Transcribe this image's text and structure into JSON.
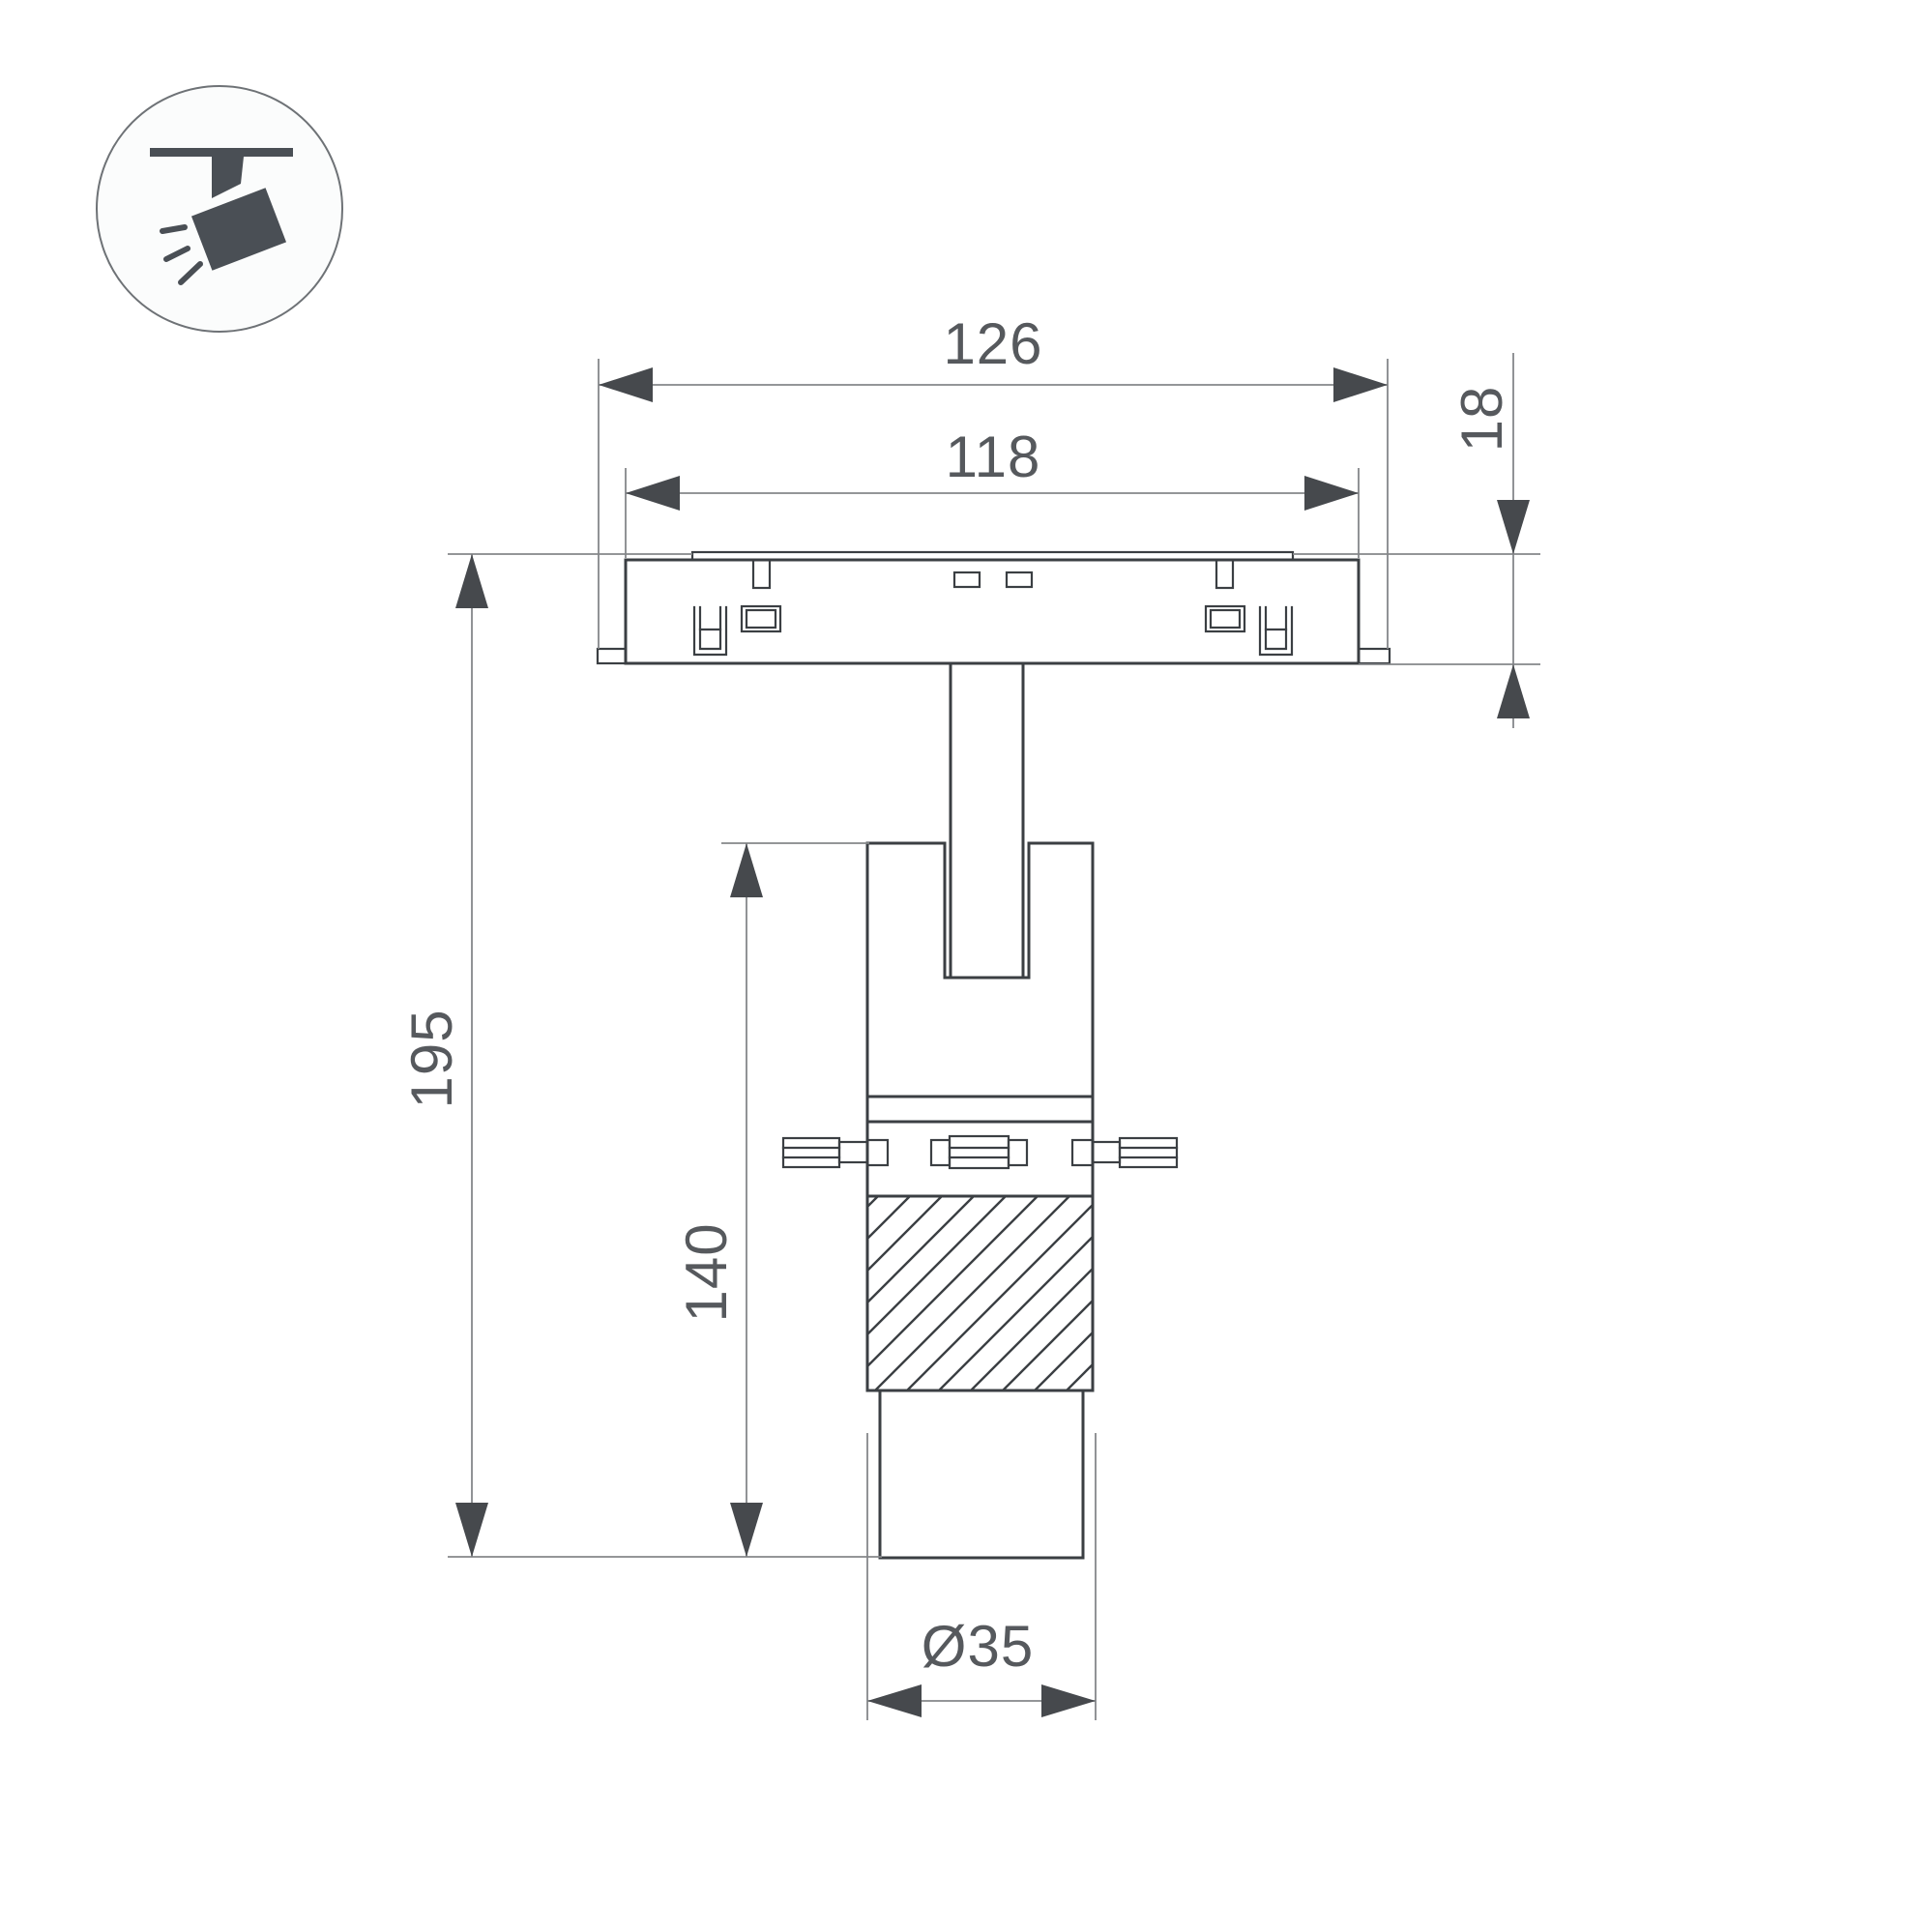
{
  "icon": {
    "name": "track-spotlight-icon"
  },
  "dimensions": {
    "track_width": "126",
    "track_inner_width": "118",
    "track_height": "18",
    "total_height": "195",
    "body_height": "140",
    "body_diameter": "Ø35"
  },
  "colors": {
    "background": "#ffffff",
    "outline": "#3b3f43",
    "dimension_line": "#85878a",
    "arrow": "#46494d",
    "dimension_text": "#56595d",
    "icon_fill": "#4a4f55"
  }
}
